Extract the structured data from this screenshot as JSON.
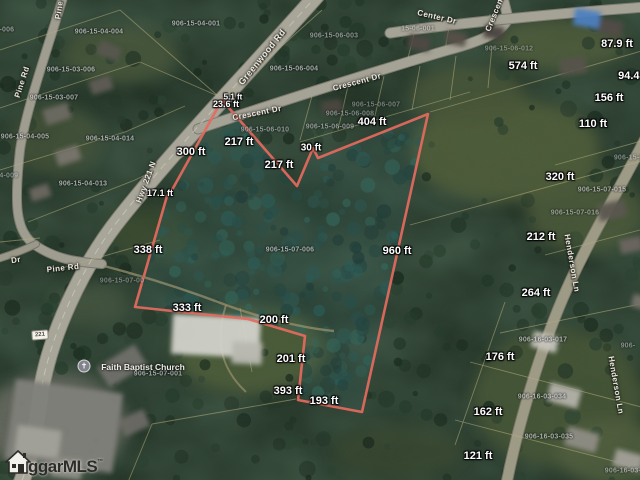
{
  "map": {
    "description": "aerial parcel map with outlined property boundary",
    "colors": {
      "boundary_red": "#e66a5e",
      "parcel_line_tan": "#b6ae7e",
      "interior_teal_tint": "#3c6e6e"
    },
    "measurement_labels": [
      {
        "text": "300 ft",
        "x": 191,
        "y": 152
      },
      {
        "text": "17.1 ft",
        "x": 160,
        "y": 193,
        "size": 9
      },
      {
        "text": "338 ft",
        "x": 148,
        "y": 250
      },
      {
        "text": "333 ft",
        "x": 187,
        "y": 308
      },
      {
        "text": "200 ft",
        "x": 274,
        "y": 320
      },
      {
        "text": "201 ft",
        "x": 291,
        "y": 359
      },
      {
        "text": "393 ft",
        "x": 288,
        "y": 391
      },
      {
        "text": "193 ft",
        "x": 324,
        "y": 401
      },
      {
        "text": "960 ft",
        "x": 397,
        "y": 251
      },
      {
        "text": "404 ft",
        "x": 372,
        "y": 122
      },
      {
        "text": "30 ft",
        "x": 311,
        "y": 148,
        "size": 10
      },
      {
        "text": "217 ft",
        "x": 239,
        "y": 142
      },
      {
        "text": "217 ft",
        "x": 279,
        "y": 165
      },
      {
        "text": "23.6 ft",
        "x": 226,
        "y": 104,
        "size": 9
      },
      {
        "text": "5.1 ft",
        "x": 233,
        "y": 97,
        "size": 8
      },
      {
        "text": "574 ft",
        "x": 523,
        "y": 66
      },
      {
        "text": "87.9 ft",
        "x": 617,
        "y": 44
      },
      {
        "text": "94.4 ft",
        "x": 634,
        "y": 76
      },
      {
        "text": "156 ft",
        "x": 609,
        "y": 98
      },
      {
        "text": "110 ft",
        "x": 593,
        "y": 124
      },
      {
        "text": "320 ft",
        "x": 560,
        "y": 177
      },
      {
        "text": "212 ft",
        "x": 541,
        "y": 237
      },
      {
        "text": "264 ft",
        "x": 536,
        "y": 293
      },
      {
        "text": "176 ft",
        "x": 500,
        "y": 357
      },
      {
        "text": "162 ft",
        "x": 488,
        "y": 412
      },
      {
        "text": "121 ft",
        "x": 478,
        "y": 456
      }
    ],
    "parcel_labels": [
      {
        "text": "906-15-04-004",
        "x": 99,
        "y": 32
      },
      {
        "text": "906-15-04-001",
        "x": 196,
        "y": 24
      },
      {
        "text": "906-15-04-006",
        "x": -10,
        "y": 30,
        "op": 0.6
      },
      {
        "text": "906-15-03-006",
        "x": 71,
        "y": 70
      },
      {
        "text": "906-15-03-007",
        "x": 54,
        "y": 98
      },
      {
        "text": "906-15-04-005",
        "x": 25,
        "y": 137
      },
      {
        "text": "906-15-04-014",
        "x": 110,
        "y": 139
      },
      {
        "text": "906-15-04-013",
        "x": 83,
        "y": 184
      },
      {
        "text": "906-15-04-009",
        "x": -6,
        "y": 176,
        "op": 0.55
      },
      {
        "text": "906-15-06-004",
        "x": 294,
        "y": 69
      },
      {
        "text": "906-15-06-003",
        "x": 334,
        "y": 36,
        "op": 0.6
      },
      {
        "text": "15-06-001",
        "x": 418,
        "y": 29,
        "op": 0.5
      },
      {
        "text": "906-15-06-010",
        "x": 265,
        "y": 130,
        "op": 0.6
      },
      {
        "text": "906-15-06-009",
        "x": 330,
        "y": 127,
        "op": 0.6
      },
      {
        "text": "906-15-06-008",
        "x": 350,
        "y": 114,
        "op": 0.5
      },
      {
        "text": "906-15-06-007",
        "x": 376,
        "y": 105,
        "op": 0.45
      },
      {
        "text": "906-15-06-012",
        "x": 509,
        "y": 49,
        "op": 0.45
      },
      {
        "text": "906-15-07-006",
        "x": 290,
        "y": 250
      },
      {
        "text": "906-15-07-001",
        "x": 158,
        "y": 374
      },
      {
        "text": "906-15-07-00",
        "x": 122,
        "y": 281,
        "op": 0.45
      },
      {
        "text": "906-15-07-015",
        "x": 602,
        "y": 190,
        "op": 0.7
      },
      {
        "text": "906-15-07-016",
        "x": 575,
        "y": 213,
        "op": 0.6
      },
      {
        "text": "906-15-07-0",
        "x": 634,
        "y": 158,
        "op": 0.5
      },
      {
        "text": "906-16-03-017",
        "x": 543,
        "y": 340
      },
      {
        "text": "906-16-03-034",
        "x": 542,
        "y": 397
      },
      {
        "text": "906-16-03-035",
        "x": 549,
        "y": 437
      },
      {
        "text": "906-16-03-01",
        "x": 627,
        "y": 471,
        "op": 0.6
      },
      {
        "text": "906-",
        "x": 628,
        "y": 346,
        "op": 0.5
      }
    ],
    "road_labels": [
      {
        "text": "Pine",
        "x": 59,
        "y": 10,
        "rot": -82
      },
      {
        "text": "Pine Rd",
        "x": 22,
        "y": 82,
        "rot": -72
      },
      {
        "text": "Pine Rd",
        "x": 63,
        "y": 268,
        "rot": -6
      },
      {
        "text": "Greenwood Rd",
        "x": 262,
        "y": 57,
        "rot": -51,
        "size": 9
      },
      {
        "text": "Hwy 221 N",
        "x": 146,
        "y": 182,
        "rot": -70
      },
      {
        "text": "Crescent Dr",
        "x": 357,
        "y": 82,
        "rot": -15
      },
      {
        "text": "Crescent Dr",
        "x": 257,
        "y": 113,
        "rot": -11
      },
      {
        "text": "Crescent Dr",
        "x": 497,
        "y": 8,
        "rot": -68
      },
      {
        "text": "Center Dr",
        "x": 437,
        "y": 17,
        "rot": 13
      },
      {
        "text": "Henderson Ln",
        "x": 572,
        "y": 263,
        "rot": 80
      },
      {
        "text": "Henderson Ln",
        "x": 616,
        "y": 385,
        "rot": 80
      },
      {
        "text": "Dr",
        "x": 16,
        "y": 260,
        "rot": -8
      }
    ],
    "poi": {
      "church_label": "Faith Baptist Church",
      "church_icon": "church-cross-icon",
      "icon_x": 84,
      "icon_y": 366,
      "label_x": 143,
      "label_y": 367,
      "cross_glyph": "✝"
    },
    "route_shield": {
      "text": "221",
      "x": 40,
      "y": 335
    },
    "watermark": {
      "icon": "house-icon",
      "text": "ggarMLS",
      "tm": "™"
    }
  }
}
